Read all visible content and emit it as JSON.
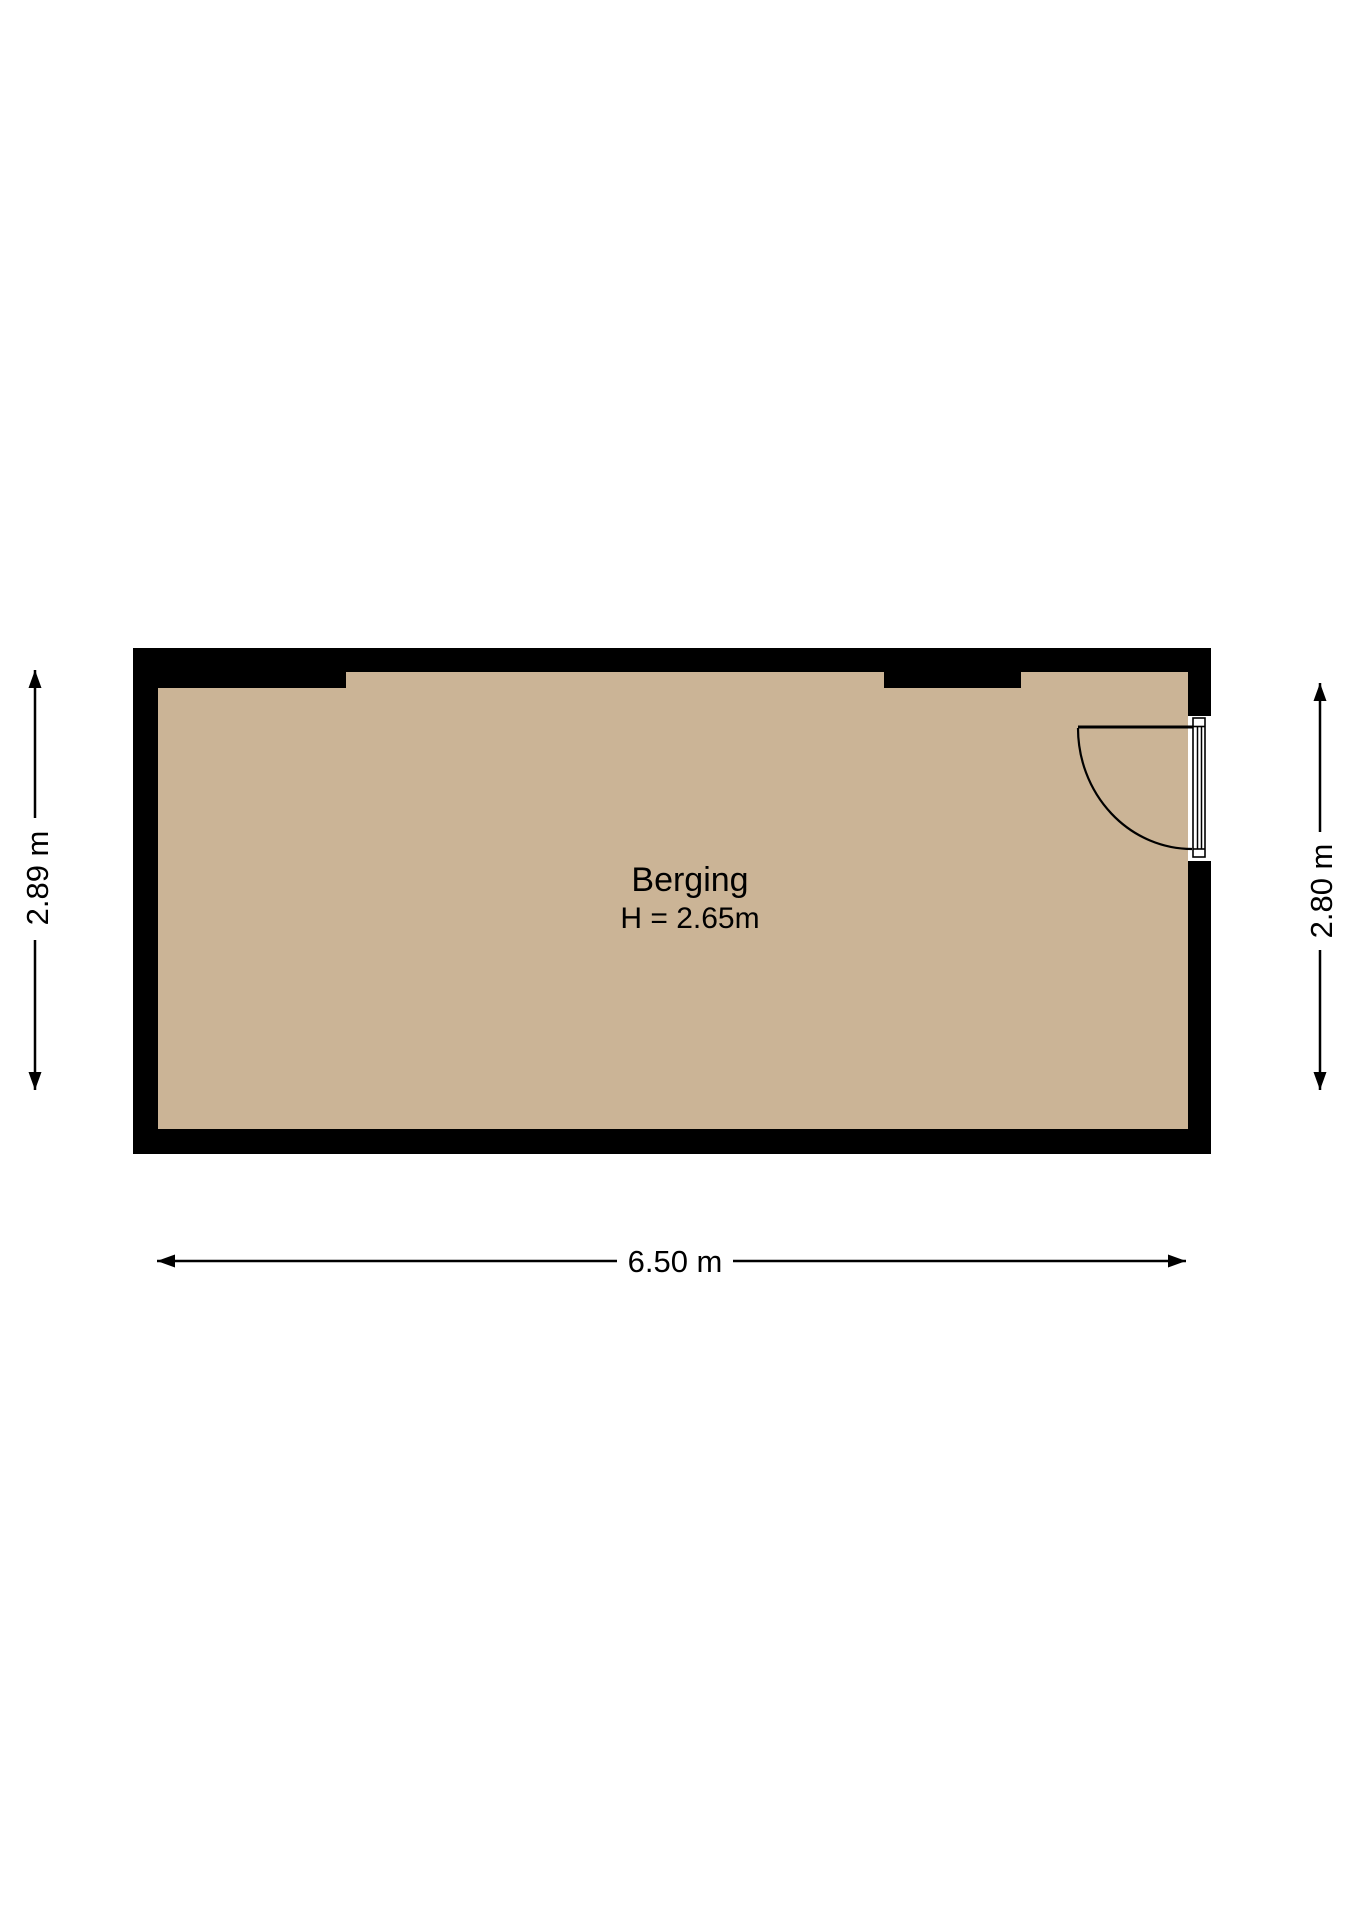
{
  "room": {
    "name": "Berging",
    "height_label": "H = 2.65m"
  },
  "dimensions": {
    "left": {
      "label": "2.89 m"
    },
    "right": {
      "label": "2.80 m"
    },
    "bottom": {
      "label": "6.50 m"
    }
  },
  "colors": {
    "background": "#ffffff",
    "floor": "#cbb496",
    "wall": "#000000",
    "line": "#000000",
    "text": "#000000",
    "door_frame_fill": "#ffffff"
  }
}
